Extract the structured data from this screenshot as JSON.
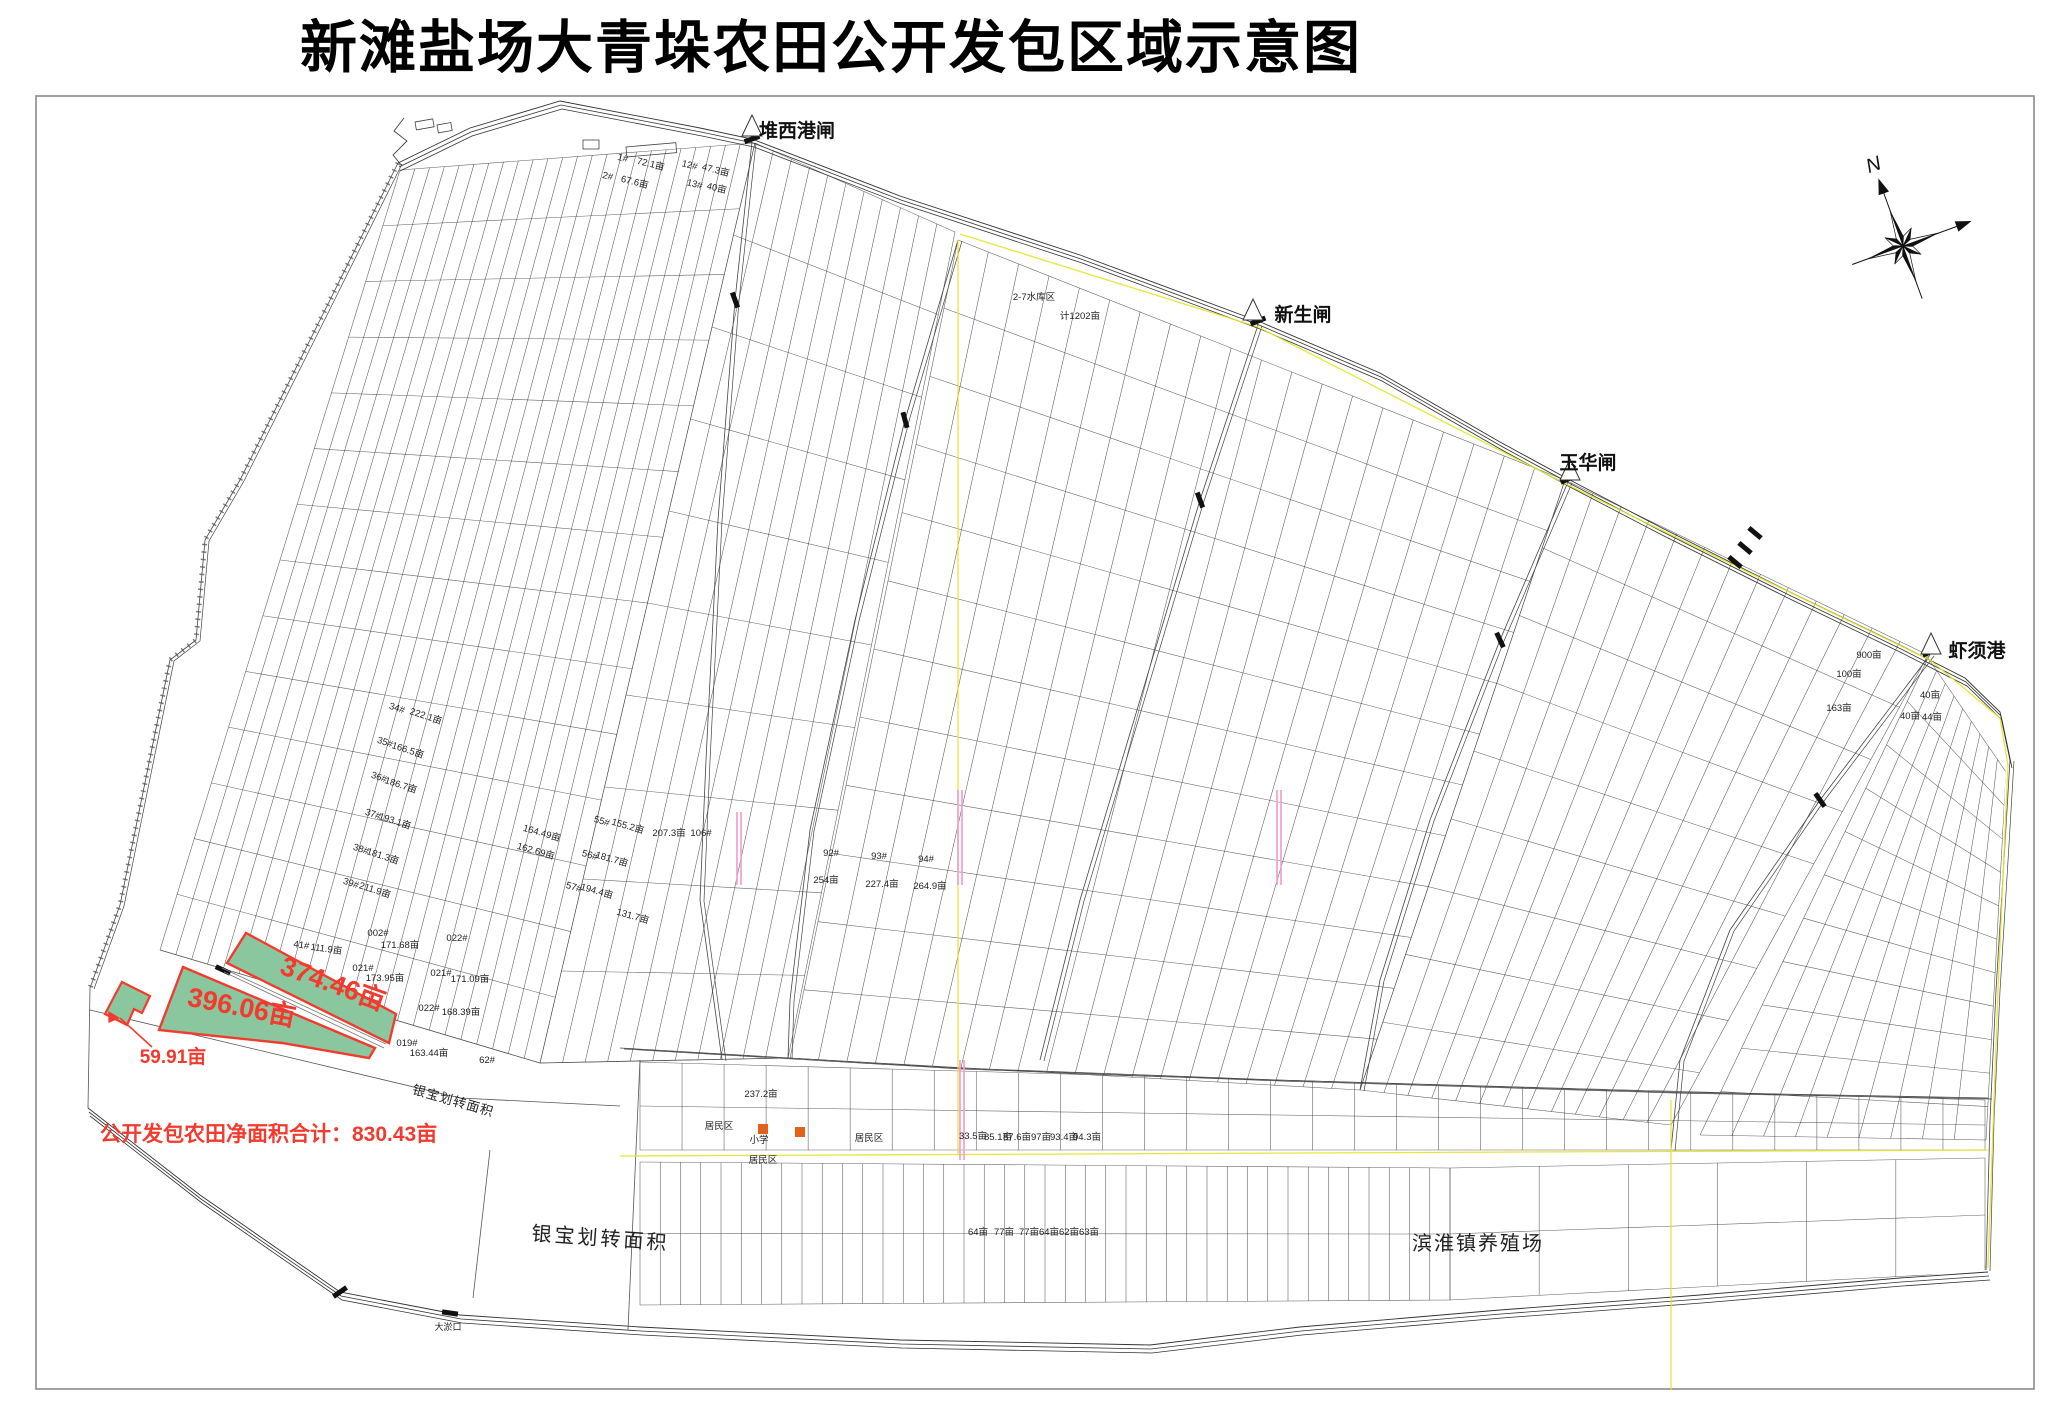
{
  "title": "新滩盐场大青垛农田公开发包区域示意图",
  "compass": {
    "label": "N"
  },
  "landmarks": [
    {
      "label": "堆西港闸",
      "x": 797,
      "y": 137
    },
    {
      "label": "新生闸",
      "x": 1303,
      "y": 321
    },
    {
      "label": "玉华闸",
      "x": 1588,
      "y": 469
    },
    {
      "label": "虾须港",
      "x": 1977,
      "y": 657
    }
  ],
  "highlight": {
    "fill": "#8bc79e",
    "stroke": "#f23a2e",
    "parcels": [
      {
        "label": "374.46亩",
        "x": 330,
        "y": 992,
        "rot": 20,
        "size": 27
      },
      {
        "label": "396.06亩",
        "x": 240,
        "y": 1016,
        "rot": 11,
        "size": 27
      },
      {
        "label": "59.91亩",
        "x": 173,
        "y": 1063,
        "rot": 0,
        "size": 19
      }
    ],
    "total": "公开发包农田净面积合计：830.43亩"
  },
  "regions": [
    {
      "label": "银宝划转面积",
      "x": 600,
      "y": 1245,
      "size": 20,
      "rot": 4,
      "ls": 3
    },
    {
      "label": "银宝划转面积",
      "x": 452,
      "y": 1105,
      "size": 13,
      "rot": 16,
      "ls": 1
    },
    {
      "label": "滨淮镇养殖场",
      "x": 1478,
      "y": 1250,
      "size": 20,
      "rot": 0,
      "ls": 2
    }
  ],
  "parcel_labels": [
    {
      "t": "1#",
      "x": 622,
      "y": 161,
      "r": 14
    },
    {
      "t": "72.1亩",
      "x": 650,
      "y": 167,
      "r": 14
    },
    {
      "t": "2#",
      "x": 607,
      "y": 179,
      "r": 14
    },
    {
      "t": "67.6亩",
      "x": 634,
      "y": 185,
      "r": 14
    },
    {
      "t": "12#",
      "x": 689,
      "y": 168,
      "r": 14
    },
    {
      "t": "47.3亩",
      "x": 715,
      "y": 173,
      "r": 14
    },
    {
      "t": "13#",
      "x": 694,
      "y": 187,
      "r": 14
    },
    {
      "t": "40亩",
      "x": 716,
      "y": 191,
      "r": 14
    },
    {
      "t": "34#",
      "x": 396,
      "y": 711,
      "r": 18
    },
    {
      "t": "222.1亩",
      "x": 425,
      "y": 719,
      "r": 18
    },
    {
      "t": "35#",
      "x": 384,
      "y": 745,
      "r": 18
    },
    {
      "t": "166.5亩",
      "x": 407,
      "y": 753,
      "r": 18
    },
    {
      "t": "36#",
      "x": 378,
      "y": 780,
      "r": 18
    },
    {
      "t": "186.7亩",
      "x": 400,
      "y": 788,
      "r": 18
    },
    {
      "t": "37#",
      "x": 372,
      "y": 817,
      "r": 18
    },
    {
      "t": "193.1亩",
      "x": 394,
      "y": 824,
      "r": 18
    },
    {
      "t": "38#",
      "x": 360,
      "y": 852,
      "r": 18
    },
    {
      "t": "181.3亩",
      "x": 382,
      "y": 859,
      "r": 18
    },
    {
      "t": "39#",
      "x": 350,
      "y": 886,
      "r": 18
    },
    {
      "t": "211.9亩",
      "x": 374,
      "y": 893,
      "r": 18
    },
    {
      "t": "55#",
      "x": 601,
      "y": 824,
      "r": 16
    },
    {
      "t": "155.2亩",
      "x": 627,
      "y": 829,
      "r": 16
    },
    {
      "t": "56#",
      "x": 589,
      "y": 858,
      "r": 16
    },
    {
      "t": "181.7亩",
      "x": 611,
      "y": 862,
      "r": 16
    },
    {
      "t": "57#",
      "x": 573,
      "y": 890,
      "r": 16
    },
    {
      "t": "194.4亩",
      "x": 596,
      "y": 894,
      "r": 16
    },
    {
      "t": "164.49亩",
      "x": 541,
      "y": 836,
      "r": 16
    },
    {
      "t": "162.69亩",
      "x": 535,
      "y": 854,
      "r": 16
    },
    {
      "t": "131.7亩",
      "x": 632,
      "y": 919,
      "r": 16
    },
    {
      "t": "207.3亩",
      "x": 669,
      "y": 836,
      "r": 0
    },
    {
      "t": "106#",
      "x": 701,
      "y": 836,
      "r": 0
    },
    {
      "t": "92#",
      "x": 831,
      "y": 856,
      "r": 0
    },
    {
      "t": "93#",
      "x": 879,
      "y": 859,
      "r": 0
    },
    {
      "t": "94#",
      "x": 926,
      "y": 862,
      "r": 0
    },
    {
      "t": "254亩",
      "x": 826,
      "y": 883,
      "r": 0
    },
    {
      "t": "227.4亩",
      "x": 882,
      "y": 887,
      "r": 0
    },
    {
      "t": "264.9亩",
      "x": 930,
      "y": 889,
      "r": 0
    },
    {
      "t": "计1202亩",
      "x": 1080,
      "y": 319,
      "r": 0
    },
    {
      "t": "2-7水库区",
      "x": 1034,
      "y": 300,
      "r": 0
    },
    {
      "t": "41#",
      "x": 301,
      "y": 948,
      "r": 8
    },
    {
      "t": "111.9亩",
      "x": 326,
      "y": 952,
      "r": 8
    },
    {
      "t": "002#",
      "x": 378,
      "y": 936,
      "r": 0
    },
    {
      "t": "171.68亩",
      "x": 400,
      "y": 948,
      "r": 0
    },
    {
      "t": "021#",
      "x": 363,
      "y": 971,
      "r": 0
    },
    {
      "t": "173.95亩",
      "x": 385,
      "y": 981,
      "r": 0
    },
    {
      "t": "022#",
      "x": 457,
      "y": 941,
      "r": 0
    },
    {
      "t": "021#",
      "x": 441,
      "y": 976,
      "r": 0
    },
    {
      "t": "171.09亩",
      "x": 470,
      "y": 982,
      "r": 0
    },
    {
      "t": "022#",
      "x": 429,
      "y": 1011,
      "r": 0
    },
    {
      "t": "168.39亩",
      "x": 461,
      "y": 1015,
      "r": 0
    },
    {
      "t": "019#",
      "x": 407,
      "y": 1046,
      "r": 0
    },
    {
      "t": "163.44亩",
      "x": 429,
      "y": 1056,
      "r": 0
    },
    {
      "t": "62#",
      "x": 487,
      "y": 1063,
      "r": 0
    },
    {
      "t": "居民区",
      "x": 719,
      "y": 1129,
      "r": 0
    },
    {
      "t": "居民区",
      "x": 869,
      "y": 1141,
      "r": 0
    },
    {
      "t": "居民区",
      "x": 763,
      "y": 1163,
      "r": 0
    },
    {
      "t": "小学",
      "x": 759,
      "y": 1143,
      "r": 0
    },
    {
      "t": "大淤口",
      "x": 448,
      "y": 1330,
      "r": 0,
      "s": 9
    },
    {
      "t": "33.5亩",
      "x": 973,
      "y": 1139,
      "r": 0
    },
    {
      "t": "85.1亩",
      "x": 998,
      "y": 1140,
      "r": 0
    },
    {
      "t": "87.6亩",
      "x": 1017,
      "y": 1140,
      "r": 0
    },
    {
      "t": "97亩",
      "x": 1041,
      "y": 1140,
      "r": 0
    },
    {
      "t": "93.4亩",
      "x": 1064,
      "y": 1140,
      "r": 0
    },
    {
      "t": "94.3亩",
      "x": 1087,
      "y": 1140,
      "r": 0
    },
    {
      "t": "64亩",
      "x": 978,
      "y": 1235,
      "r": 0
    },
    {
      "t": "77亩",
      "x": 1004,
      "y": 1235,
      "r": 0
    },
    {
      "t": "77亩",
      "x": 1029,
      "y": 1235,
      "r": 0
    },
    {
      "t": "64亩",
      "x": 1049,
      "y": 1235,
      "r": 0
    },
    {
      "t": "62亩",
      "x": 1069,
      "y": 1235,
      "r": 0
    },
    {
      "t": "63亩",
      "x": 1089,
      "y": 1235,
      "r": 0
    },
    {
      "t": "237.2亩",
      "x": 761,
      "y": 1097,
      "r": 0
    },
    {
      "t": "900亩",
      "x": 1869,
      "y": 658,
      "r": 0
    },
    {
      "t": "100亩",
      "x": 1849,
      "y": 677,
      "r": 0
    },
    {
      "t": "163亩",
      "x": 1839,
      "y": 711,
      "r": 0
    },
    {
      "t": "40亩",
      "x": 1930,
      "y": 698,
      "r": 0
    },
    {
      "t": "40亩",
      "x": 1910,
      "y": 719,
      "r": 0
    },
    {
      "t": "44亩",
      "x": 1932,
      "y": 720,
      "r": 0
    }
  ]
}
